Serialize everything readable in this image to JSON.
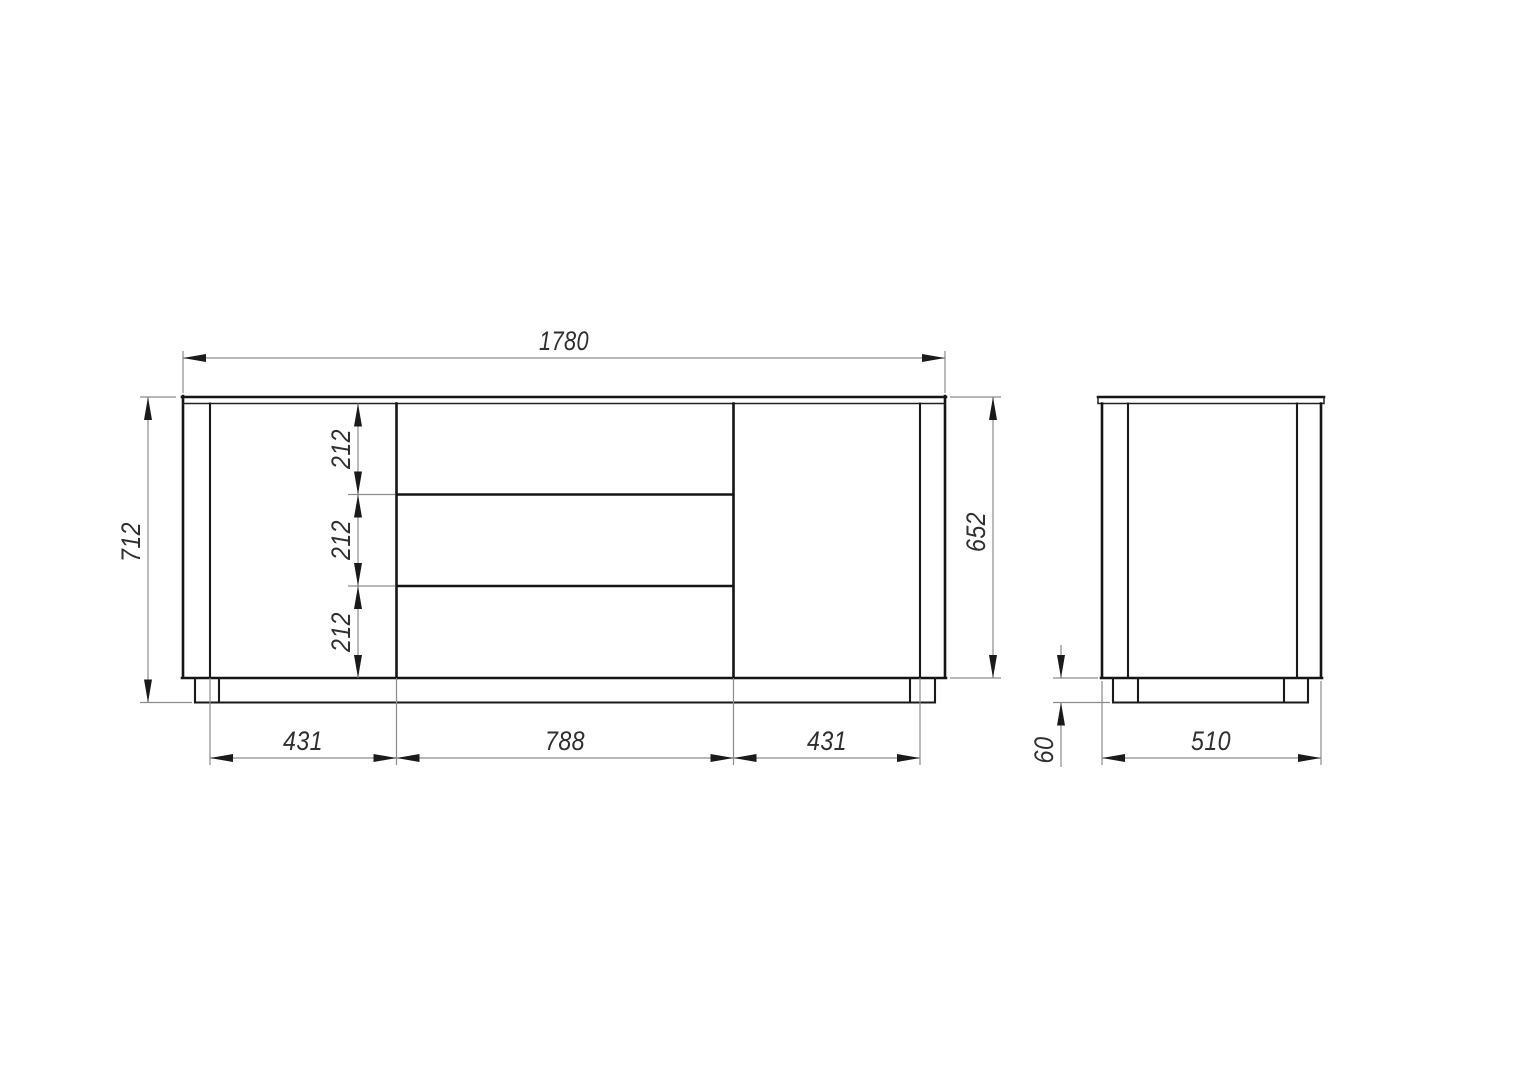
{
  "canvas": {
    "background": "#ffffff",
    "object_line_color": "#151515",
    "dimension_line_color": "#8c8c8c",
    "text_color": "#2f2f2f"
  },
  "drawing": {
    "front_view": {
      "total_width": "1780",
      "total_height": "712",
      "body_height": "652",
      "drawer_heights": [
        "212",
        "212",
        "212"
      ],
      "section_widths": [
        "431",
        "788",
        "431"
      ]
    },
    "side_view": {
      "depth": "510",
      "plinth_height": "60"
    }
  }
}
